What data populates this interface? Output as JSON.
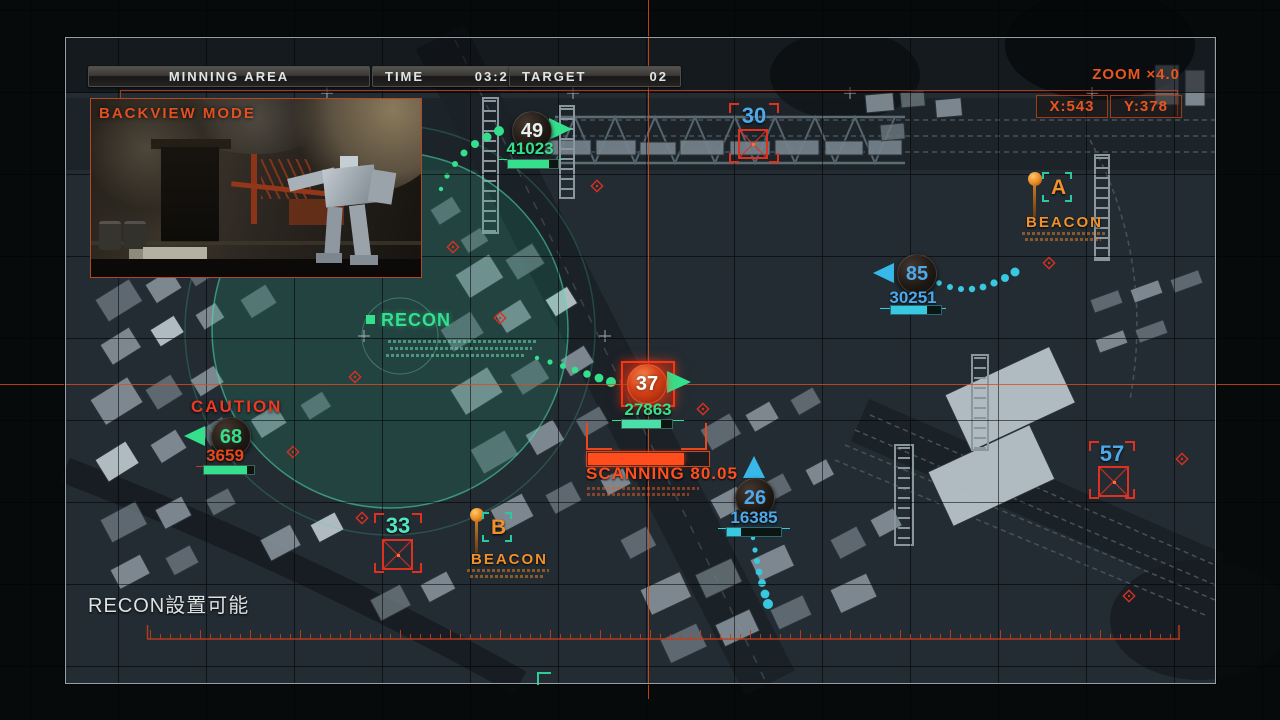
{
  "header": {
    "area": "MINNING AREA",
    "time_label": "TIME",
    "time_value": "03:20",
    "target_label": "TARGET",
    "target_value": "02"
  },
  "zoom_hud": {
    "label": "ZOOM ×4.0",
    "x": "X:543",
    "y": "Y:378"
  },
  "backview": {
    "title": "BACKVIEW MODE"
  },
  "recon": {
    "label": "RECON"
  },
  "caution_label": "CAUTION",
  "scan": {
    "label": "SCANNING 80.05",
    "progress_pct": 80
  },
  "beacons": {
    "a": {
      "letter": "A",
      "label": "BEACON"
    },
    "b": {
      "letter": "B",
      "label": "BEACON"
    }
  },
  "units": {
    "u49": {
      "num": "49",
      "value": "41023",
      "bar_pct": 82
    },
    "u85": {
      "num": "85",
      "value": "30251",
      "bar_pct": 72
    },
    "u37": {
      "num": "37",
      "value": "27863",
      "bar_pct": 78
    },
    "u68": {
      "num": "68",
      "value": "3659",
      "bar_pct": 86
    },
    "u26": {
      "num": "26",
      "value": "16385",
      "bar_pct": 26
    }
  },
  "targets": {
    "t30": "30",
    "t33": "33",
    "t57": "57"
  },
  "status_message": "RECON設置可能",
  "controls": [
    {
      "button": "L",
      "label": "移動"
    },
    {
      "button": "R2",
      "label": "スキャン"
    },
    {
      "button": "L2",
      "label": "スポット"
    },
    {
      "button": "R3",
      "label": "バックビュー"
    },
    {
      "button": "L3",
      "label": "RECON設置"
    }
  ],
  "colors": {
    "hud_orange": "#e8551e",
    "beacon_orange": "#f0912c",
    "hud_green": "#35e08c",
    "hud_blue": "#4da9ea",
    "hud_cyan": "#38c8e0",
    "alert_red": "#e33022"
  }
}
